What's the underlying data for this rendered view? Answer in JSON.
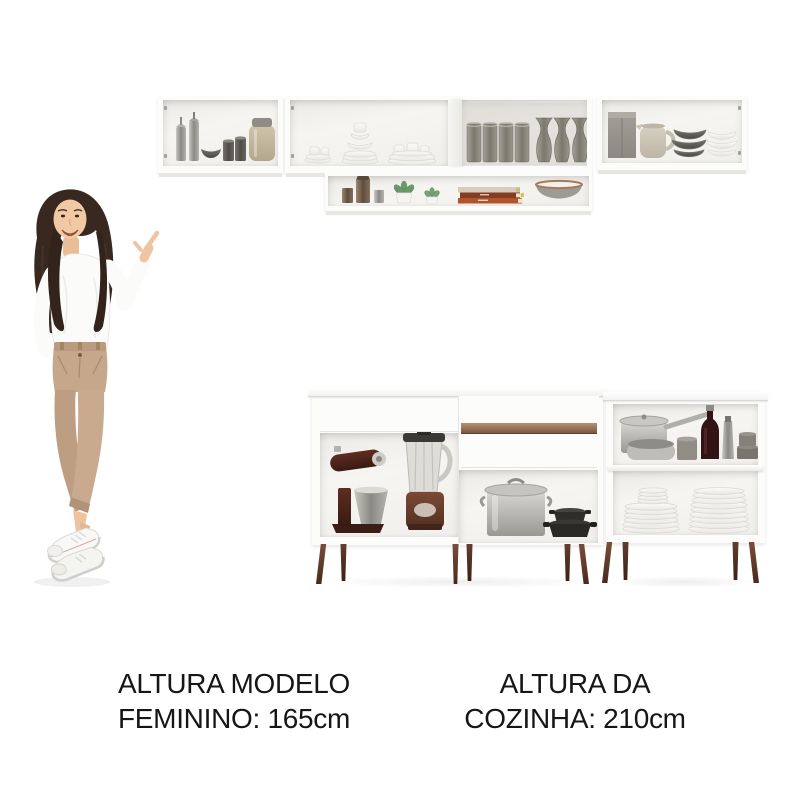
{
  "background_color": "#ffffff",
  "captions": {
    "model_height": {
      "line1": "ALTURA MODELO",
      "line2": "FEMININO: 165cm"
    },
    "kitchen_height": {
      "line1": "ALTURA DA",
      "line2": "COZINHA: 210cm"
    }
  },
  "colors": {
    "text": "#161616",
    "cabinet_white": "#fbfbfa",
    "cabinet_interior": "#f1f0ec",
    "drawer_handle": "#8f6c56",
    "wood_legs": "#5f3a29",
    "pants": "#c4a58a",
    "hair": "#382820",
    "skin": "#efc5a1",
    "succulent_green": "#6d9a6d",
    "book_spine_orange": "#b0542c",
    "wine_bottle": "#331414"
  },
  "scene": {
    "model": {
      "pose": "standing with legs crossed, right hand pointing up toward the wall cabinets, left hand in pocket",
      "outfit": [
        "white long-sleeve top",
        "beige high-waist trousers",
        "white sneakers"
      ]
    },
    "wall_cabinets": {
      "left_cabinet_items": [
        "steel candle canisters",
        "gray bowl",
        "dark cups",
        "beige lidded jar"
      ],
      "middle_cabinet_items": [
        "white cups and saucers",
        "white plate stacks",
        "gray tumblers",
        "tall gray glasses"
      ],
      "right_cabinet_items": [
        "gray box",
        "beige pitcher",
        "dark bowl stack",
        "white bowl stack"
      ],
      "lower_shelf_items": [
        "metal canisters",
        "two potted succulents",
        "stacked books",
        "gray bowl with copper rim"
      ]
    },
    "base_cabinets": {
      "left_unit_items": [
        "stand mixer",
        "blender",
        "stockpot with lid",
        "black cast-iron pans"
      ],
      "left_unit_features": [
        "drawer with wood-tone recessed handle",
        "open compartments",
        "tapered wood legs"
      ],
      "right_unit_items": [
        "saucepan with long handle",
        "frying pan",
        "gray pot",
        "wine bottle",
        "metal flask",
        "gray canisters",
        "two stacks of white plates"
      ]
    }
  }
}
